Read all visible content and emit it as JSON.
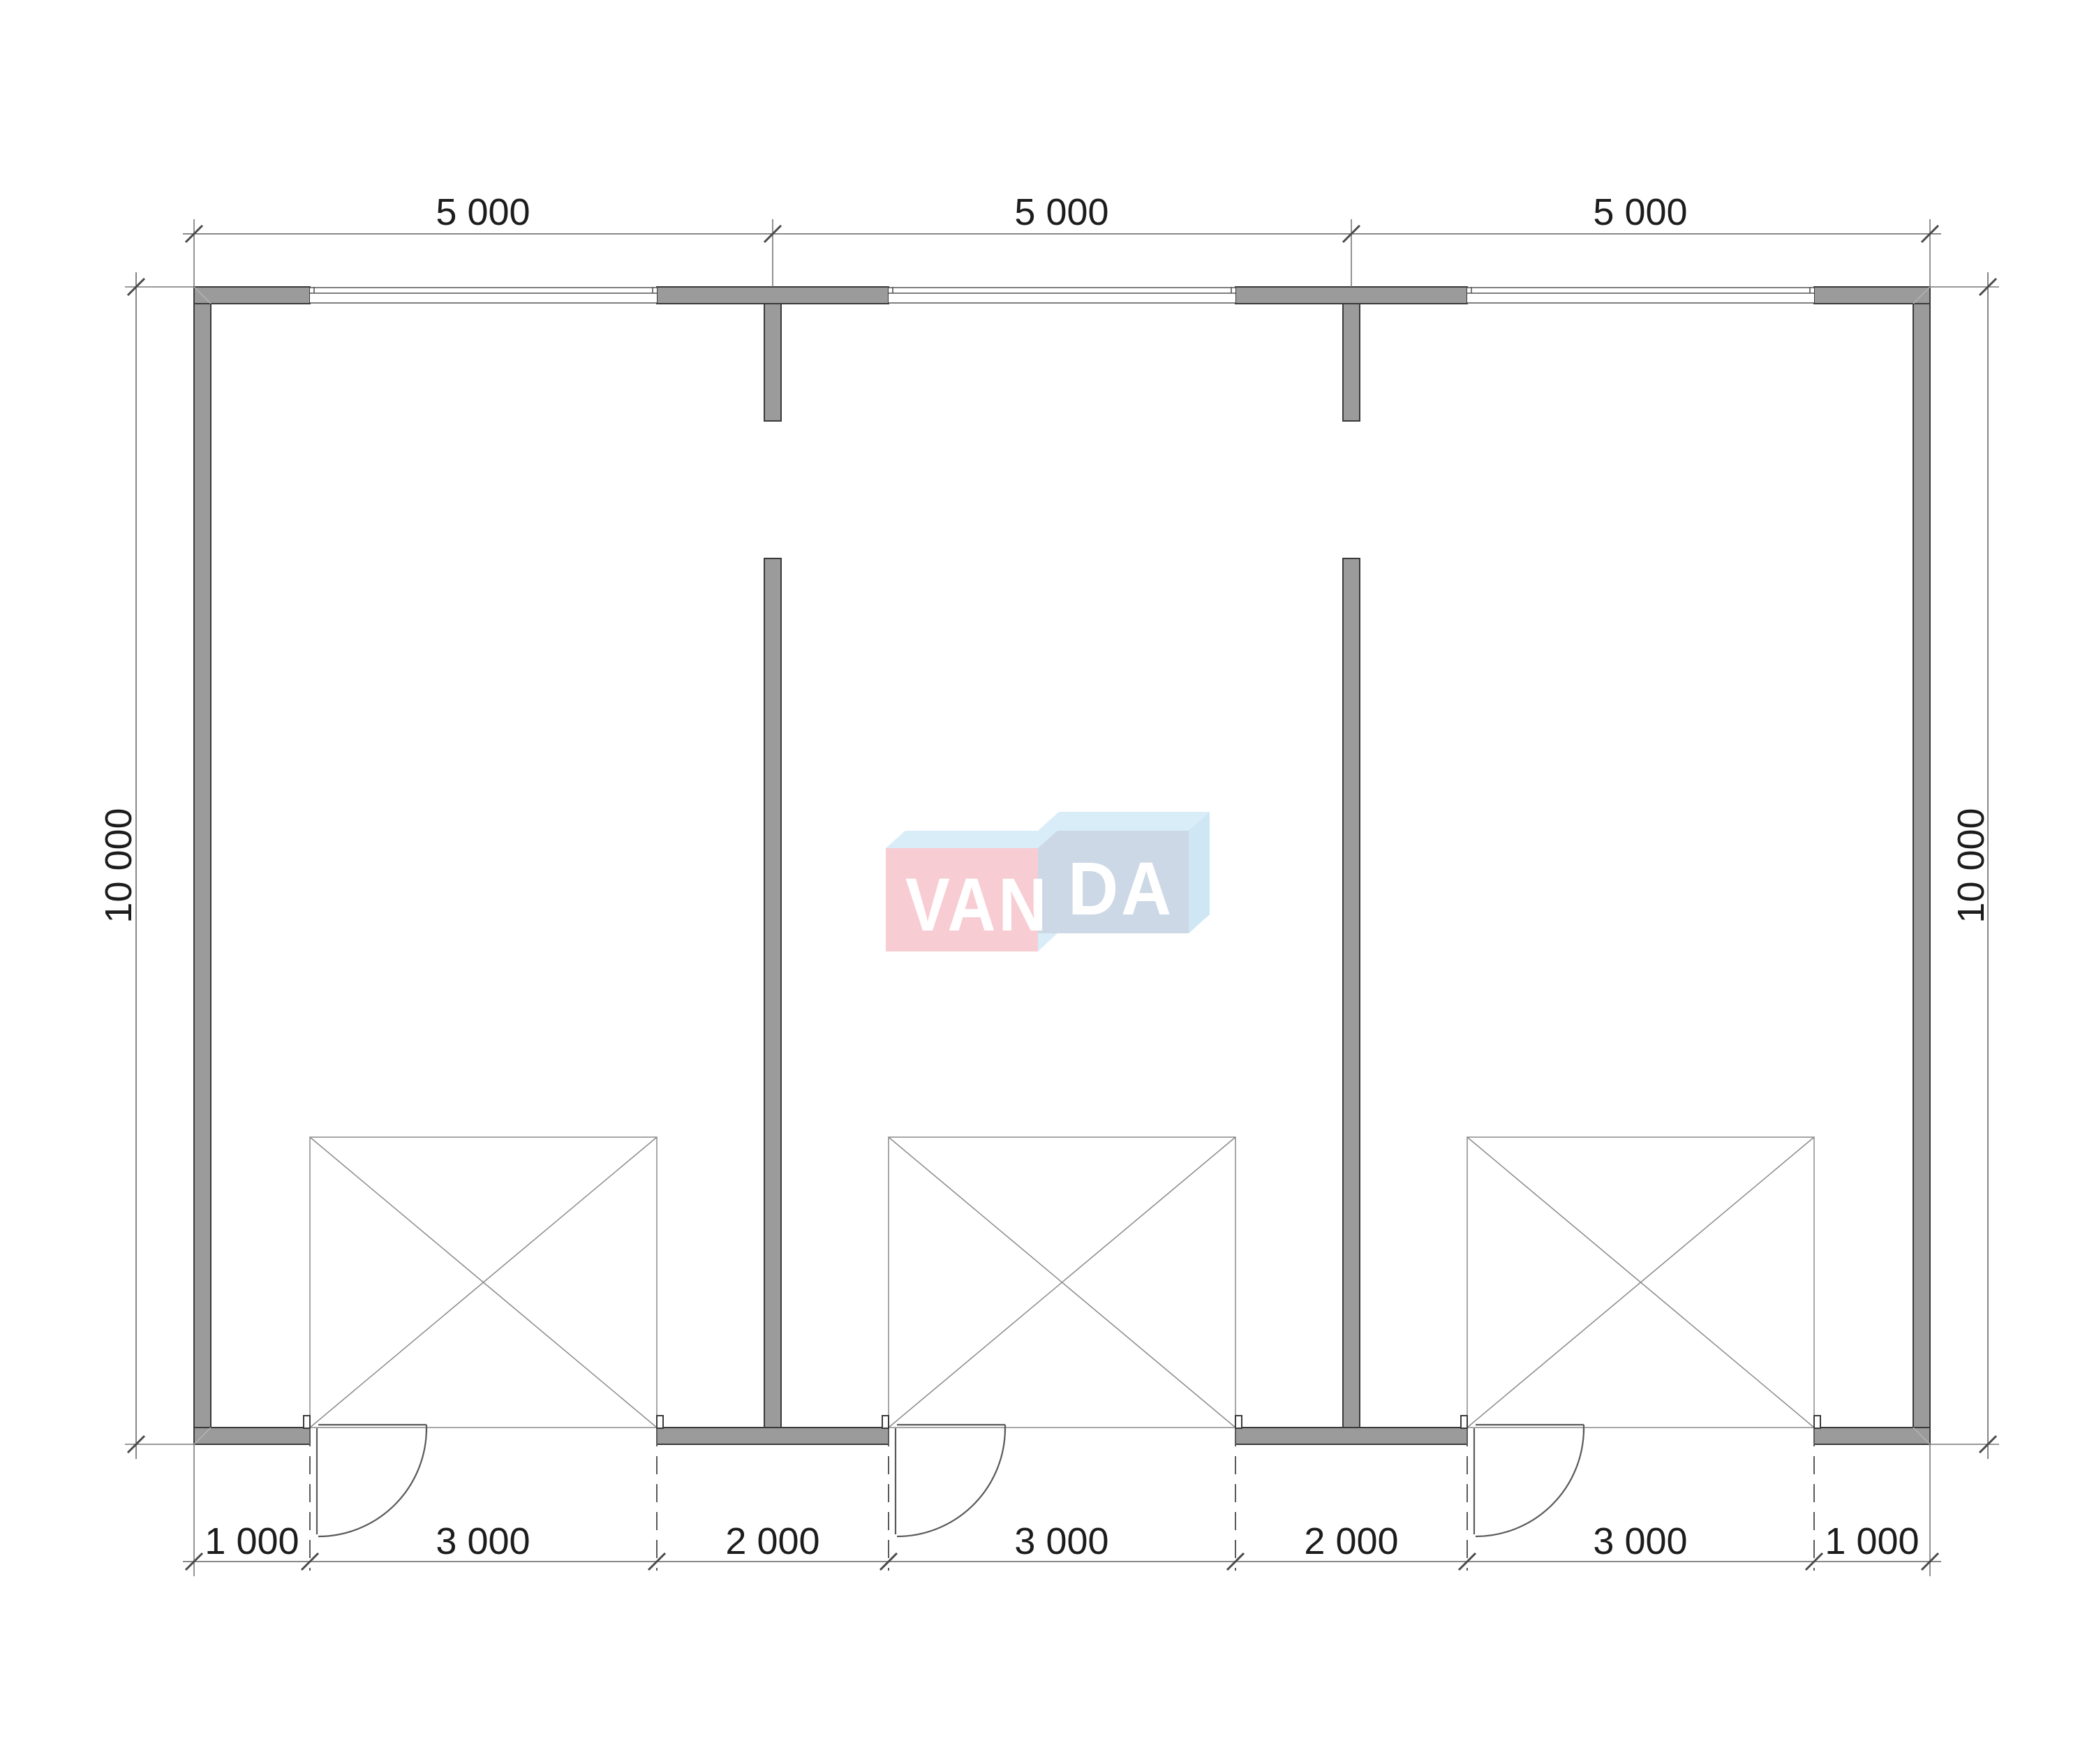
{
  "drawing": {
    "type": "floor-plan",
    "description": "Three-bay garage floor plan with dimension lines and VANDA watermark",
    "bays": 3
  },
  "dimensions": {
    "top": [
      "5 000",
      "5 000",
      "5 000"
    ],
    "bottom": [
      "1 000",
      "3 000",
      "2 000",
      "3 000",
      "2 000",
      "3 000",
      "1 000"
    ],
    "left": "10 000",
    "right": "10 000"
  },
  "watermark": {
    "part1": "VAN",
    "part2": "DA"
  },
  "colors": {
    "wall_fill": "#9b9b9b",
    "wall_edge": "#3a3a3a",
    "dim_line": "#787878",
    "text": "#1c1c1c",
    "wm_pink": "#f8ccd3",
    "wm_blue_front": "#ccd8e5",
    "wm_cyan_top": "#d9edf8",
    "wm_blue_side": "#cfe6f4",
    "wm_letters": "#ffffff"
  }
}
